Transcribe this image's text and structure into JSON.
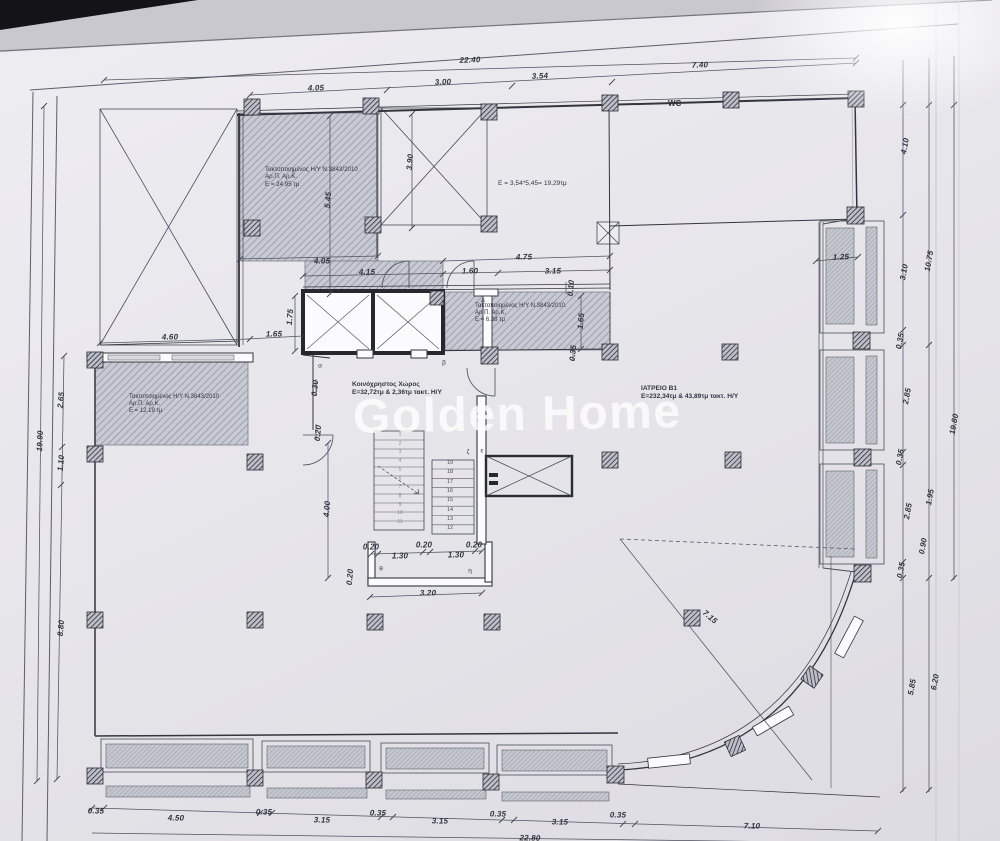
{
  "watermark": {
    "text": "Golden Home"
  },
  "plan": {
    "rooms": [
      {
        "id": "room1",
        "lines": [
          "Τακτοποιημένος Η/Υ Ν.3843/2010",
          "Αρ.Π. Αρ.Κ.",
          "Ε = 24.95 τμ"
        ]
      },
      {
        "id": "room2",
        "lines": [
          "Ε = 3,54*5,45= 19,29τμ"
        ]
      },
      {
        "id": "room3",
        "lines": [
          "Τακτοποιημένος Η/Υ Ν.3843/2010.",
          "Αρ.Π. Αρ.Κ.",
          "Ε = 6.38 τμ"
        ]
      },
      {
        "id": "room4",
        "lines": [
          "Τακτοποιημένος Η/Υ Ν.3843/2010",
          "Αρ.Π. Αρ.Κ.",
          "Ε = 12.19 τμ"
        ]
      },
      {
        "id": "common",
        "lines": [
          "Κοινόχρηστος Χώρος",
          "Ε=32,72τμ & 2,36τμ τακτ. Η/Υ"
        ]
      },
      {
        "id": "iatreio",
        "lines": [
          "ΙΑΤΡΕΙΟ Β1",
          "Ε=232,34τμ & 43,89τμ τακτ. Η/Υ"
        ]
      },
      {
        "id": "wc",
        "lines": [
          "WC"
        ]
      }
    ],
    "dimension_labels": [
      {
        "t": "22.40",
        "x": 470,
        "y": 60,
        "r": -2
      },
      {
        "t": "4.05",
        "x": 316,
        "y": 88,
        "r": -2
      },
      {
        "t": "3.00",
        "x": 443,
        "y": 82,
        "r": -2
      },
      {
        "t": "3.54",
        "x": 540,
        "y": 76,
        "r": -2
      },
      {
        "t": "7.40",
        "x": 700,
        "y": 65,
        "r": -2
      },
      {
        "t": "3.90",
        "x": 410,
        "y": 162,
        "r": -85
      },
      {
        "t": "5.45",
        "x": 328,
        "y": 200,
        "r": -85
      },
      {
        "t": "4.05",
        "x": 322,
        "y": 261,
        "r": -1
      },
      {
        "t": "4.15",
        "x": 367,
        "y": 272,
        "r": -1
      },
      {
        "t": "1.60",
        "x": 470,
        "y": 271,
        "r": -1
      },
      {
        "t": "4.75",
        "x": 524,
        "y": 257,
        "r": -1
      },
      {
        "t": "3.15",
        "x": 553,
        "y": 271,
        "r": -1
      },
      {
        "t": "0.10",
        "x": 571,
        "y": 288,
        "r": -85
      },
      {
        "t": "1.65",
        "x": 581,
        "y": 321,
        "r": -85
      },
      {
        "t": "0.35",
        "x": 573,
        "y": 353,
        "r": -85
      },
      {
        "t": "1.75",
        "x": 290,
        "y": 317,
        "r": -85
      },
      {
        "t": "1.65",
        "x": 274,
        "y": 334,
        "r": -1
      },
      {
        "t": "4.60",
        "x": 170,
        "y": 337,
        "r": -1
      },
      {
        "t": "0.30",
        "x": 315,
        "y": 388,
        "r": -85
      },
      {
        "t": "0.20",
        "x": 318,
        "y": 433,
        "r": -85
      },
      {
        "t": "4.00",
        "x": 327,
        "y": 509,
        "r": -85
      },
      {
        "t": "0.20",
        "x": 371,
        "y": 547,
        "r": 0
      },
      {
        "t": "0.20",
        "x": 424,
        "y": 545,
        "r": 0
      },
      {
        "t": "0.20",
        "x": 474,
        "y": 545,
        "r": 0
      },
      {
        "t": "1.30",
        "x": 400,
        "y": 556,
        "r": 0
      },
      {
        "t": "1.30",
        "x": 456,
        "y": 555,
        "r": 0
      },
      {
        "t": "0.20",
        "x": 350,
        "y": 577,
        "r": -85
      },
      {
        "t": "3.20",
        "x": 428,
        "y": 593,
        "r": -1
      },
      {
        "t": "1.25",
        "x": 841,
        "y": 257,
        "r": -2
      },
      {
        "t": "19.90",
        "x": 40,
        "y": 441,
        "r": -87
      },
      {
        "t": "2.65",
        "x": 61,
        "y": 400,
        "r": -85
      },
      {
        "t": "1.10",
        "x": 61,
        "y": 463,
        "r": -85
      },
      {
        "t": "8.80",
        "x": 61,
        "y": 628,
        "r": -85
      },
      {
        "t": "4.10",
        "x": 905,
        "y": 146,
        "r": -80
      },
      {
        "t": "3.10",
        "x": 904,
        "y": 272,
        "r": -80
      },
      {
        "t": "10.75",
        "x": 929,
        "y": 261,
        "r": -80
      },
      {
        "t": "0.35",
        "x": 900,
        "y": 341,
        "r": -80
      },
      {
        "t": "2.85",
        "x": 907,
        "y": 396,
        "r": -80
      },
      {
        "t": "0.35",
        "x": 900,
        "y": 457,
        "r": -80
      },
      {
        "t": "2.85",
        "x": 908,
        "y": 511,
        "r": -80
      },
      {
        "t": "19.80",
        "x": 954,
        "y": 424,
        "r": -80
      },
      {
        "t": "1.95",
        "x": 930,
        "y": 497,
        "r": -80
      },
      {
        "t": "0.90",
        "x": 923,
        "y": 546,
        "r": -80
      },
      {
        "t": "0.35",
        "x": 901,
        "y": 570,
        "r": -80
      },
      {
        "t": "5.85",
        "x": 912,
        "y": 687,
        "r": -80
      },
      {
        "t": "6.20",
        "x": 935,
        "y": 682,
        "r": -80
      },
      {
        "t": "7.15",
        "x": 710,
        "y": 617,
        "r": 40
      },
      {
        "t": "0.35",
        "x": 96,
        "y": 811,
        "r": 1
      },
      {
        "t": "4.50",
        "x": 176,
        "y": 818,
        "r": 1
      },
      {
        "t": "0.35",
        "x": 264,
        "y": 812,
        "r": 1
      },
      {
        "t": "3.15",
        "x": 322,
        "y": 820,
        "r": 1
      },
      {
        "t": "0.35",
        "x": 378,
        "y": 813,
        "r": 1
      },
      {
        "t": "3.15",
        "x": 440,
        "y": 821,
        "r": 1
      },
      {
        "t": "0.35",
        "x": 498,
        "y": 814,
        "r": 1
      },
      {
        "t": "3.15",
        "x": 560,
        "y": 822,
        "r": 1
      },
      {
        "t": "0.35",
        "x": 618,
        "y": 815,
        "r": 1
      },
      {
        "t": "7.10",
        "x": 752,
        "y": 826,
        "r": 1
      },
      {
        "t": "22.80",
        "x": 530,
        "y": 838,
        "r": 1
      }
    ],
    "grid_letters": [
      {
        "t": "α",
        "x": 320,
        "y": 366
      },
      {
        "t": "β",
        "x": 444,
        "y": 363
      },
      {
        "t": "γ",
        "x": 443,
        "y": 301
      },
      {
        "t": "δ",
        "x": 483,
        "y": 301
      },
      {
        "t": "ε",
        "x": 482,
        "y": 451
      },
      {
        "t": "ζ",
        "x": 468,
        "y": 452
      },
      {
        "t": "η",
        "x": 470,
        "y": 571
      },
      {
        "t": "θ",
        "x": 381,
        "y": 569
      }
    ],
    "stairs": {
      "right_numbers": [
        "19",
        "18",
        "17",
        "16",
        "15",
        "14",
        "13",
        "12"
      ],
      "left_numbers": [
        "1",
        "2",
        "3",
        "4",
        "5",
        "6",
        "7",
        "8",
        "9",
        "10",
        "11"
      ]
    }
  },
  "colors": {
    "paper": "#e7e6eb",
    "ink": "#3b3c46",
    "wall": "#2c2d36",
    "hatch": "#9096a3",
    "watermark": "#ffffff"
  }
}
